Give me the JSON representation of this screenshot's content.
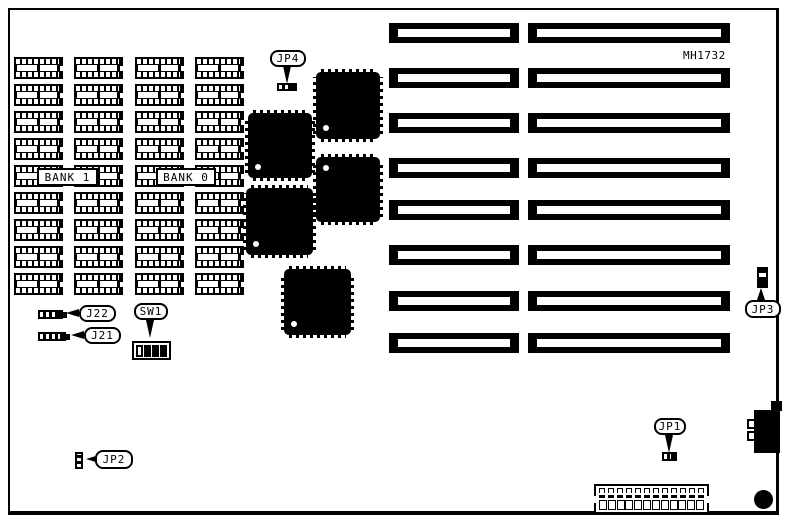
{
  "board_code": "MH1732",
  "labels": {
    "bank1": "BANK 1",
    "bank0": "BANK 0",
    "j22": "J22",
    "j21": "J21",
    "sw1": "SW1",
    "jp1": "JP1",
    "jp2": "JP2",
    "jp3": "JP3",
    "jp4": "JP4"
  },
  "memory": {
    "banks": 2,
    "columns": 4,
    "rows": 9
  },
  "expansion_slots": {
    "rows": 8,
    "columns": 2
  },
  "ic_chips": {
    "count": 5
  },
  "sw1": {
    "switch_states": [
      "open",
      "closed",
      "closed",
      "closed"
    ]
  },
  "power_connector": {
    "pins_top": 12,
    "pins_bottom": 12
  },
  "colors": {
    "ink": "#000000",
    "background": "#ffffff"
  }
}
